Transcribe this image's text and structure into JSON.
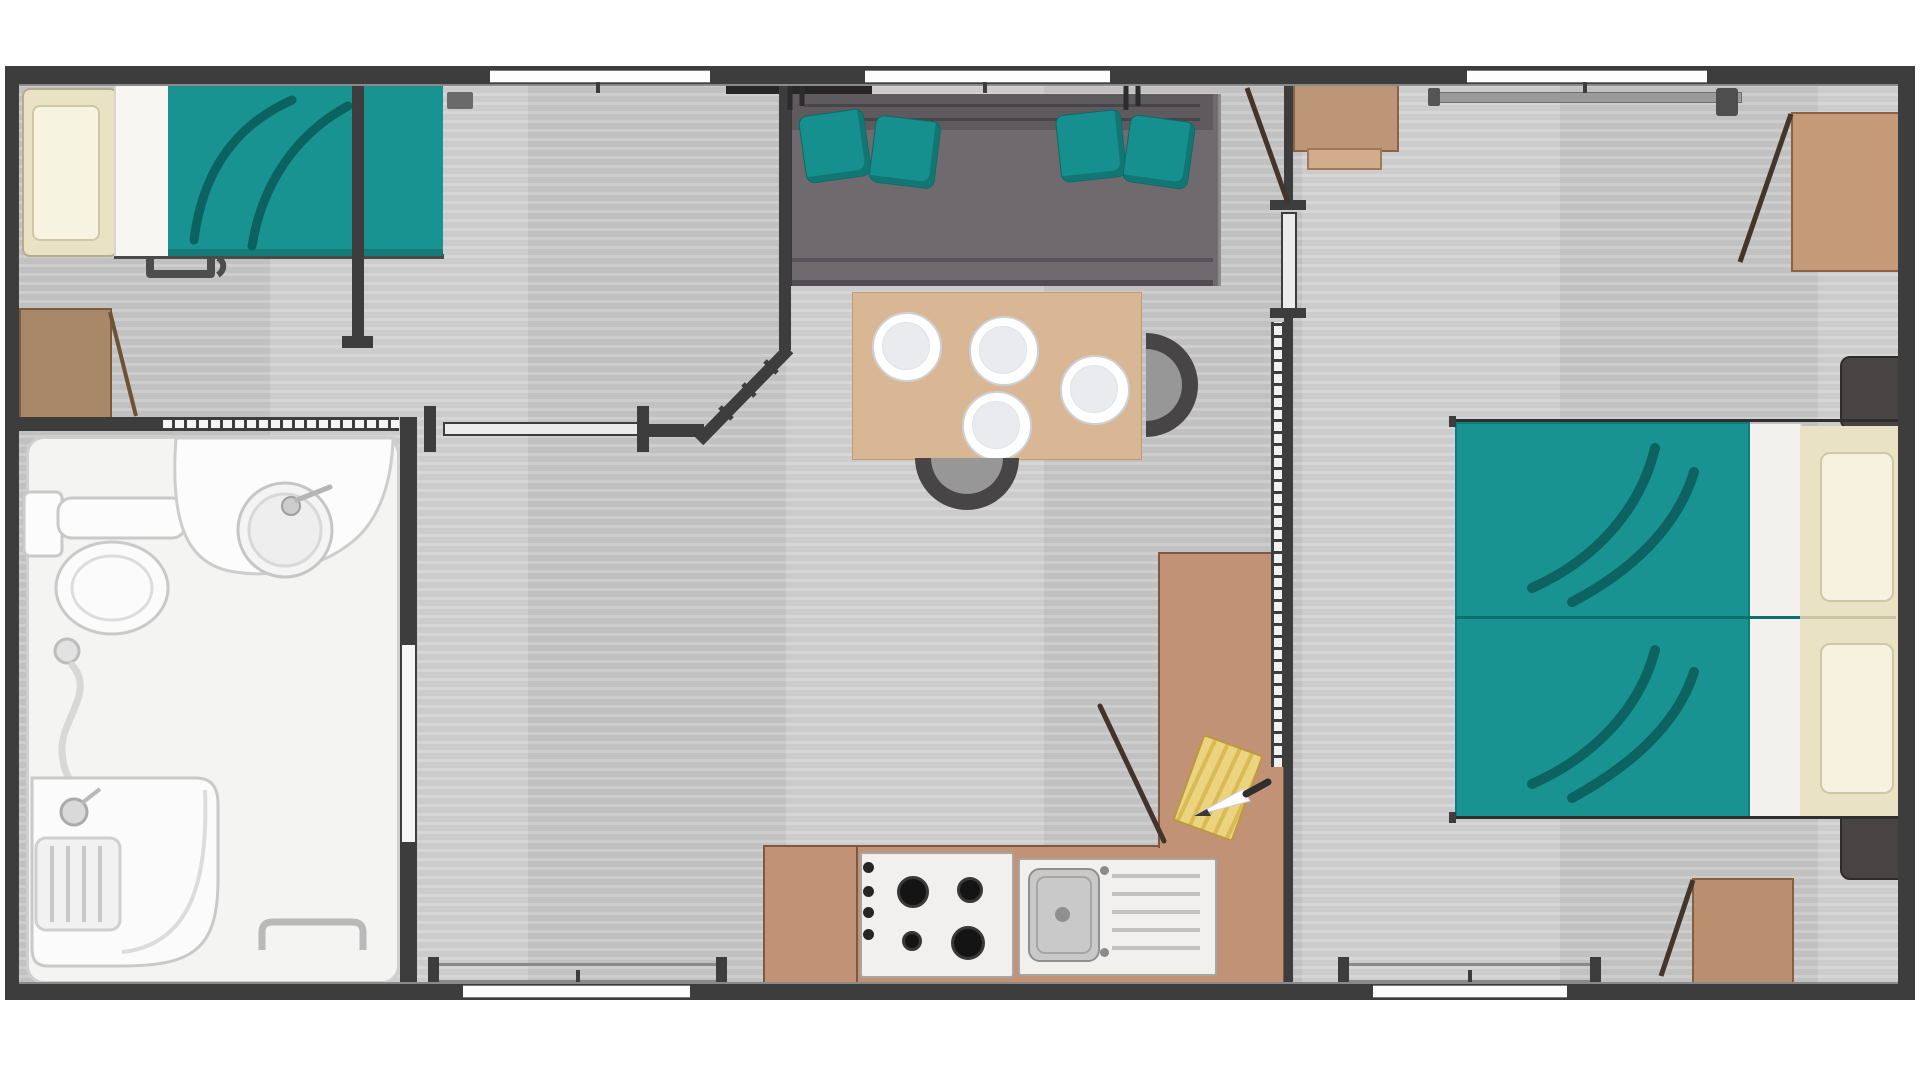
{
  "meta": {
    "type": "floor-plan",
    "subject": "mobile-home two-bedroom layout",
    "visible_text": "none"
  },
  "palette": {
    "wall": "#3d3d3d",
    "floor": "#c9c9c9",
    "teal": "#189391",
    "teal_dark": "#0c6260",
    "sofa_gray": "#6e6a6e",
    "table_wood": "#d9b795",
    "counter_wood": "#c29276",
    "wardrobe_wood": "#bd9577",
    "desk_wood": "#a98769",
    "bathroom_white": "#f4f4f3",
    "pillow_cream": "#e9e2c4"
  },
  "labels": {
    "plan": "Mobile home floor plan",
    "bedroom_left": "Left bedroom",
    "bathroom": "Bathroom",
    "living": "Living area",
    "kitchen": "Kitchen",
    "bedroom_right": "Right bedroom",
    "bed1": "Single bed",
    "pillow": "Pillow",
    "duvet": "Teal duvet",
    "stool": "Bed step",
    "desk": "Desk",
    "desk_door": "Open door",
    "toilet": "Toilet",
    "basin": "Washbasin",
    "shower": "Shower",
    "towel": "Towel rail",
    "bath_door": "Bathroom door",
    "sofa": "Sofa",
    "cushion": "Teal cushion",
    "tv": "Wall-mounted shelf",
    "table": "Dining table",
    "plate": "Plate",
    "chair": "Half-round chair",
    "counter": "Kitchen counter",
    "stove": "Gas hob",
    "sink": "Kitchen sink",
    "board": "Cutting board",
    "knife": "Knife",
    "broom": "Broom",
    "bed2": "Double bed",
    "pillows2": "Pillows",
    "nightstand": "Nightstand",
    "wardrobe": "Wardrobe",
    "cabinet": "Storage cabinet",
    "shelf": "Shelf",
    "curtain_rail": "Curtain rail",
    "window": "Window",
    "entry": "Entrance sliding door",
    "partition": "Partition wall",
    "sliding_door": "Sliding door",
    "room_door": "Room door"
  },
  "inventory": {
    "windows_top": 3,
    "windows_bottom": 2,
    "sofa_cushions": 4,
    "dining_plates": 4,
    "dining_chairs": 2,
    "hob_burners": 4,
    "hob_knobs": 4,
    "bedrooms": 2,
    "wardrobes": 3,
    "nightstands": 2,
    "beds": 2
  }
}
